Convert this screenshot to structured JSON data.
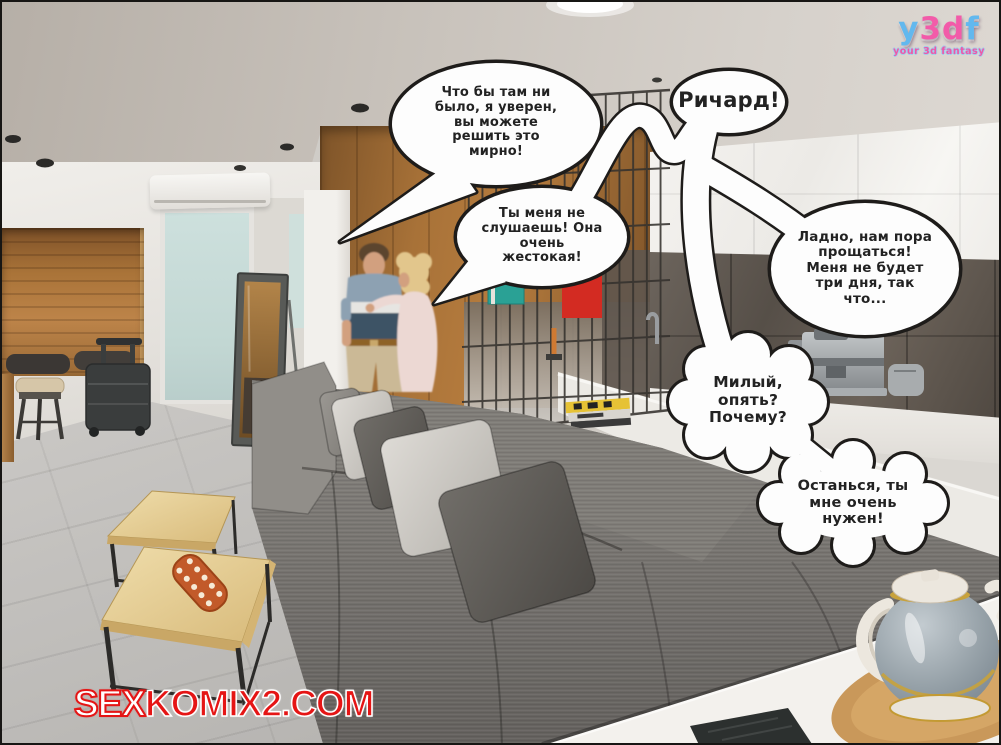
{
  "logo": {
    "letters": [
      "y",
      "3",
      "d",
      "f"
    ],
    "subtitle": "your 3d fantasy",
    "brand_blue": "#62b8ee",
    "brand_pink": "#f25ba9"
  },
  "watermark": {
    "part1": "SEX",
    "part2": "KOMIX2.COM",
    "color": "#e51515"
  },
  "bubbles": [
    {
      "name": "speech-bubble-1",
      "text": "Что бы там ни\nбыло, я уверен,\nвы можете\nрешить это\nмирно!"
    },
    {
      "name": "speech-bubble-2",
      "text": "Ричард!"
    },
    {
      "name": "speech-bubble-3",
      "text": "Ты меня не\nслушаешь! Она\nочень\nжестокая!"
    },
    {
      "name": "speech-bubble-4",
      "text": "Ладно, нам пора\nпрощаться!\nМеня не будет\nтри дня, так\nчто..."
    },
    {
      "name": "speech-bubble-5",
      "text": "Милый,\nопять?\nПочему?"
    },
    {
      "name": "speech-bubble-6",
      "text": "Останься, ты\nмне очень\nнужен!"
    }
  ]
}
